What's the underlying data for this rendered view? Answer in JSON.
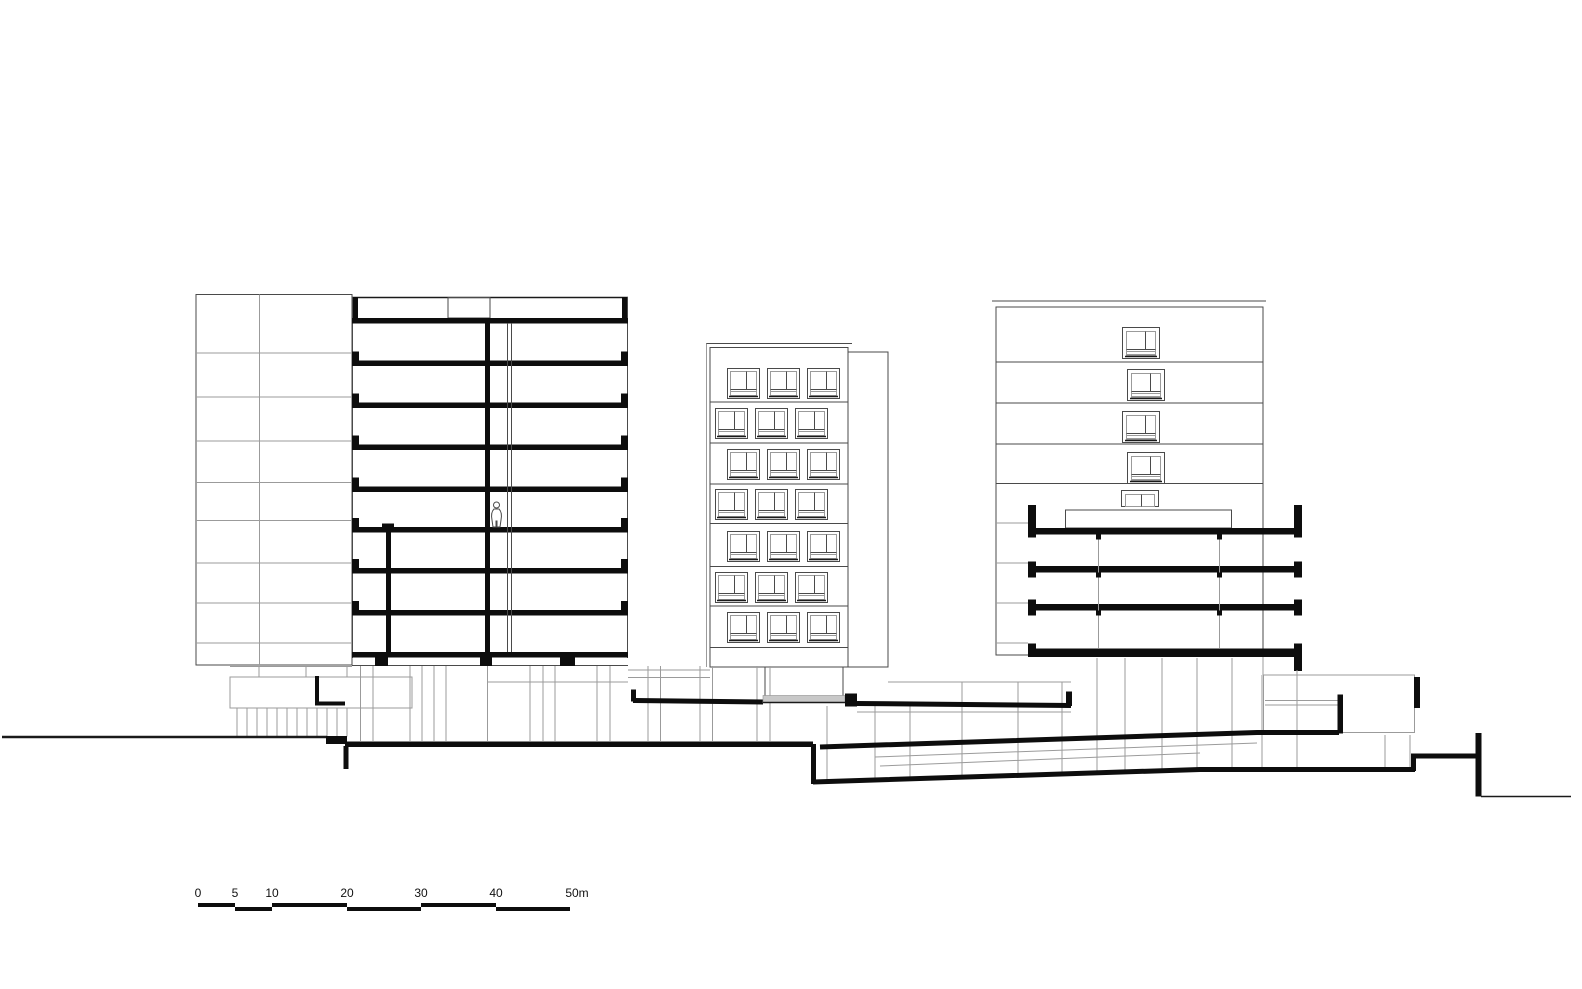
{
  "scale_bar": {
    "labels": [
      "0",
      "5",
      "10",
      "20",
      "30",
      "40",
      "50m"
    ]
  },
  "colors": {
    "ink": "#0d0d0d",
    "medium_line": "#4a4a4a",
    "light_line": "#9b9b9b",
    "canopy_fill": "#c8c8c8",
    "background": "#ffffff"
  }
}
